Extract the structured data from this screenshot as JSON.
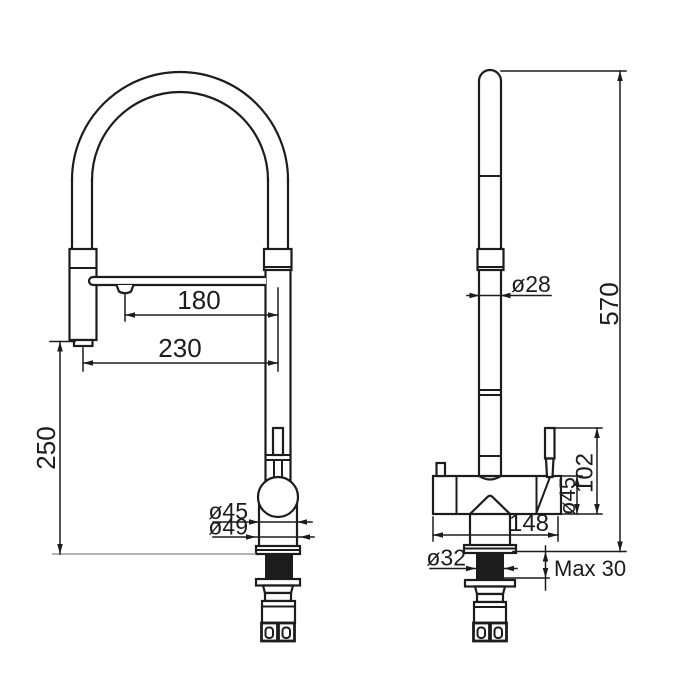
{
  "page": {
    "background": "#ffffff",
    "line_color": "#1c1c1c",
    "counter_line_color": "#9c9c9c",
    "subject": "kitchen faucet technical dimension drawing, front and side views"
  },
  "views": {
    "front": {
      "dimensions": {
        "spout_to_axis": "180",
        "head_to_axis": "230",
        "head_height_above_counter": "250",
        "body_diameter": "ø45",
        "base_diameter": "ø49"
      }
    },
    "side": {
      "dimensions": {
        "column_diameter": "ø28",
        "overall_height": "570",
        "handle_block_height": "102",
        "body_diameter": "ø45",
        "body_length": "148",
        "shank_diameter": "ø32",
        "max_deck_thickness": "Max 30"
      }
    }
  }
}
